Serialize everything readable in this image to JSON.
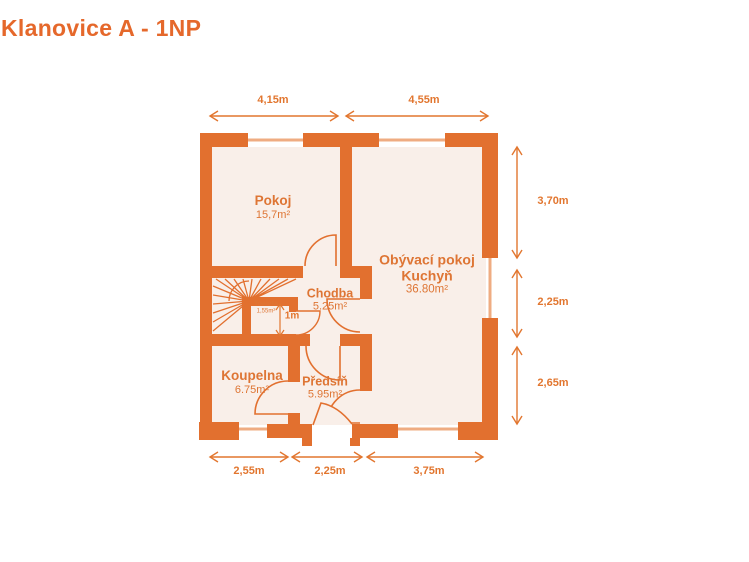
{
  "title": "Klanovice A - 1NP",
  "floor": "1NP",
  "colors": {
    "wall": "#E2702F",
    "room_fill": "#F9EFE9",
    "window_glass": "#EFAC82",
    "accent_text": "#DE7534",
    "dimension": "#E2762F",
    "background": "#FFFFFF"
  },
  "rooms": [
    {
      "id": "pokoj",
      "name": "Pokoj",
      "area": "15,7m²"
    },
    {
      "id": "obyvaci-pokoj-kuchyn",
      "name": "Obývací pokoj",
      "name2": "Kuchyň",
      "area": "36.80m²"
    },
    {
      "id": "chodba",
      "name": "Chodba",
      "area": "5.25m²"
    },
    {
      "id": "toaleta",
      "name": "Toaleta",
      "area": "1,55m²"
    },
    {
      "id": "koupelna",
      "name": "Koupelna",
      "area": "6.75m²"
    },
    {
      "id": "predsin",
      "name": "Předsíň",
      "area": "5.95m²"
    }
  ],
  "dimensions": {
    "top": [
      "4,15m",
      "4,55m"
    ],
    "right": [
      "3,70m",
      "2,25m",
      "2,65m"
    ],
    "bottom": [
      "2,55m",
      "2,25m",
      "3,75m"
    ],
    "interior": [
      "1m"
    ]
  }
}
